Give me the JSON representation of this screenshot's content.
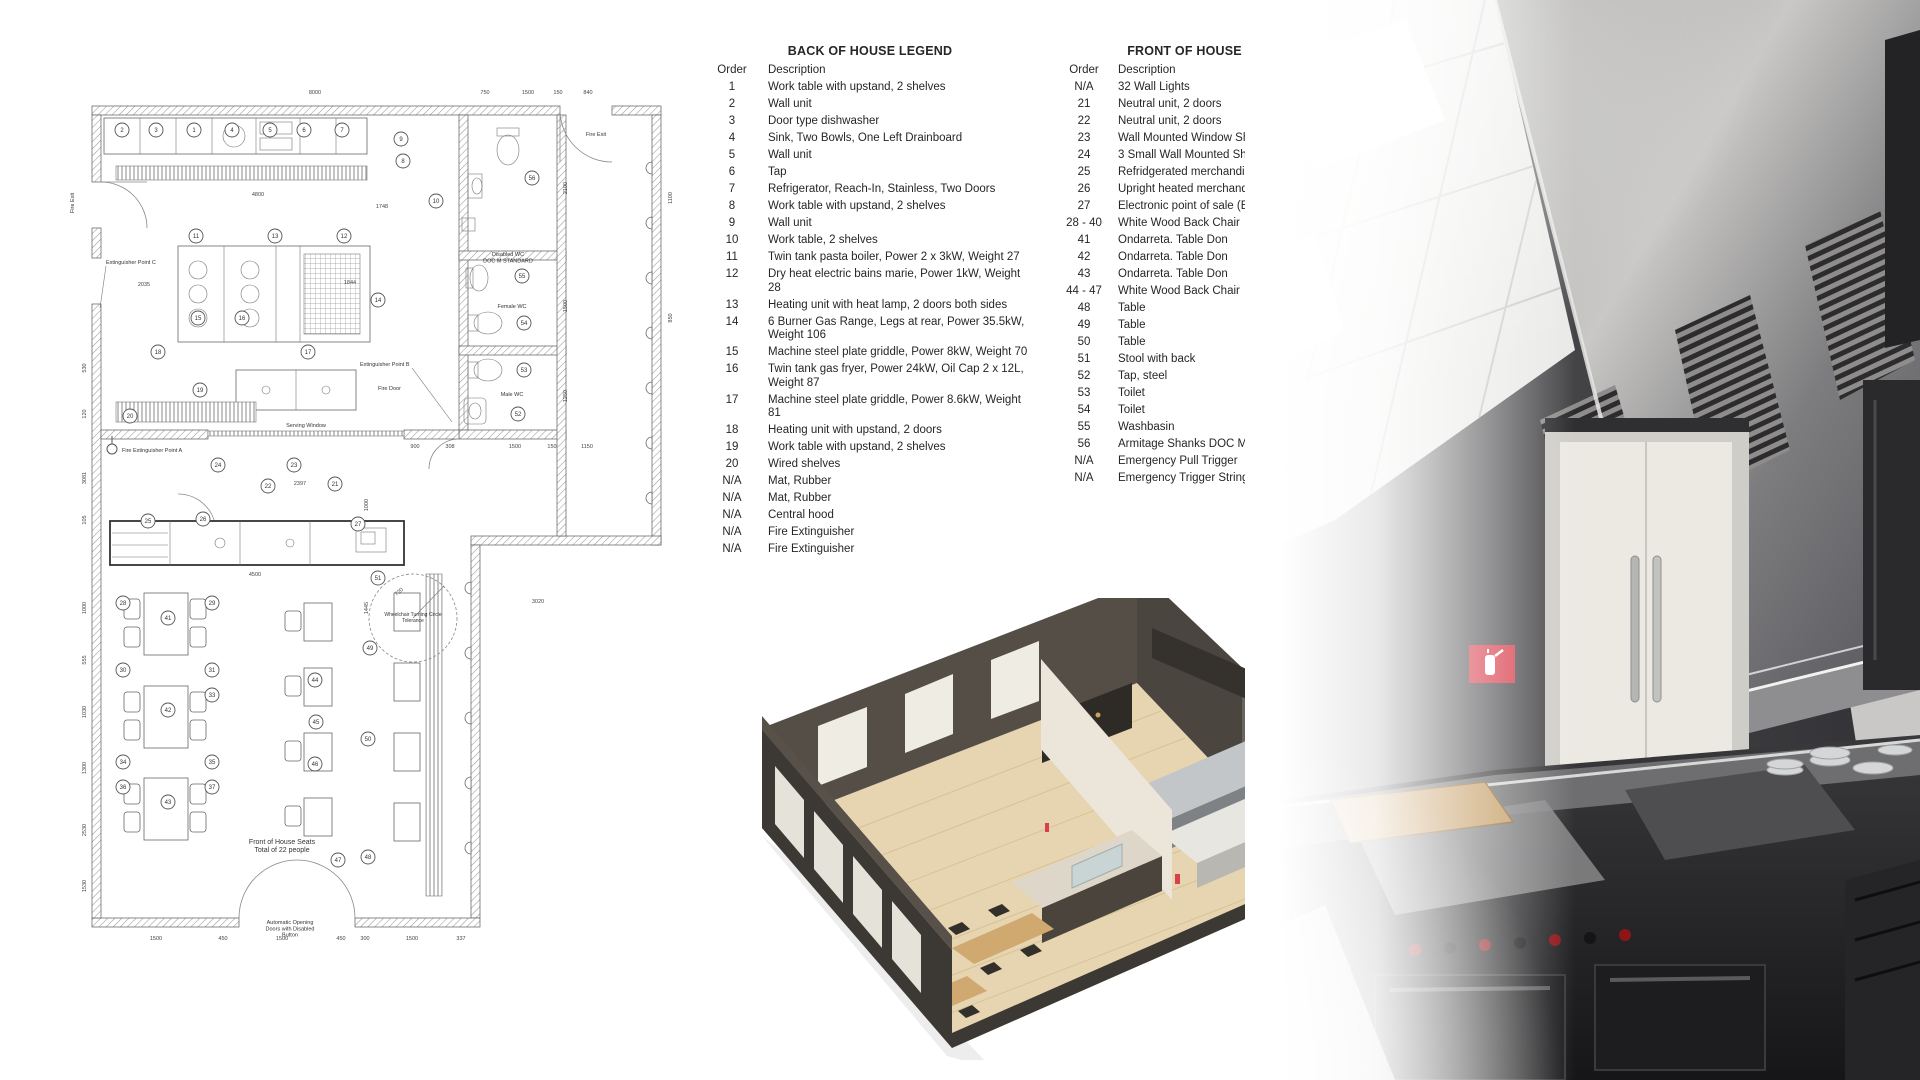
{
  "colors": {
    "accent-red": "#d9404e",
    "plan-line": "#5a5a5a",
    "legend-text": "#262626",
    "iso-floor": "#e6d5b0",
    "iso-wall": "#4a453e",
    "iso-wood": "#cfa970",
    "photo-wall": "#3b3a3c",
    "photo-steel": "#b9b8b6"
  },
  "legends": {
    "boh": {
      "title": "BACK OF HOUSE LEGEND",
      "order_header": "Order",
      "description_header": "Description",
      "rows": [
        [
          "1",
          "Work table with upstand, 2 shelves"
        ],
        [
          "2",
          "Wall unit"
        ],
        [
          "3",
          "Door type dishwasher"
        ],
        [
          "4",
          "Sink, Two Bowls, One Left Drainboard"
        ],
        [
          "5",
          "Wall unit"
        ],
        [
          "6",
          "Tap"
        ],
        [
          "7",
          "Refrigerator, Reach-In, Stainless, Two Doors"
        ],
        [
          "8",
          "Work table with upstand, 2 shelves"
        ],
        [
          "9",
          "Wall unit"
        ],
        [
          "10",
          "Work table, 2 shelves"
        ],
        [
          "11",
          "Twin tank pasta boiler, Power 2 x 3kW, Weight 27"
        ],
        [
          "12",
          "Dry heat electric bains marie, Power 1kW, Weight 28"
        ],
        [
          "13",
          "Heating unit with heat lamp, 2 doors both sides"
        ],
        [
          "14",
          "6 Burner Gas Range, Legs at rear, Power 35.5kW, Weight 106"
        ],
        [
          "15",
          "Machine steel plate griddle, Power 8kW, Weight 70"
        ],
        [
          "16",
          "Twin tank gas fryer, Power 24kW, Oil Cap 2 x 12L, Weight 87"
        ],
        [
          "17",
          "Machine steel plate griddle, Power 8.6kW, Weight 81"
        ],
        [
          "18",
          "Heating unit with upstand, 2 doors"
        ],
        [
          "19",
          "Work table with upstand, 2 shelves"
        ],
        [
          "20",
          "Wired shelves"
        ],
        [
          "N/A",
          "Mat, Rubber"
        ],
        [
          "N/A",
          "Mat, Rubber"
        ],
        [
          "N/A",
          "Central hood"
        ],
        [
          "N/A",
          "Fire Extinguisher"
        ],
        [
          "N/A",
          "Fire Extinguisher"
        ]
      ]
    },
    "foh": {
      "title": "FRONT OF HOUSE LEGEND",
      "order_header": "Order",
      "description_header": "Description",
      "rows": [
        [
          "N/A",
          "32 Wall Lights"
        ],
        [
          "21",
          "Neutral unit, 2 doors"
        ],
        [
          "22",
          "Neutral unit, 2 doors"
        ],
        [
          "23",
          "Wall Mounted Window Shelf"
        ],
        [
          "24",
          "3 Small Wall Mounted Shelves"
        ],
        [
          "25",
          "Refridgerated merchandiser"
        ],
        [
          "26",
          "Upright heated merchandiser"
        ],
        [
          "27",
          "Electronic point of sale (EPOS system)"
        ],
        [
          "28 - 40",
          "White Wood Back Chair"
        ],
        [
          "41",
          "Ondarreta. Table Don"
        ],
        [
          "42",
          "Ondarreta. Table Don"
        ],
        [
          "43",
          "Ondarreta. Table Don"
        ],
        [
          "44 - 47",
          "White Wood Back Chair"
        ],
        [
          "48",
          "Table"
        ],
        [
          "49",
          "Table"
        ],
        [
          "50",
          "Table"
        ],
        [
          "51",
          "Stool with back"
        ],
        [
          "52",
          "Tap, steel"
        ],
        [
          "53",
          "Toilet"
        ],
        [
          "54",
          "Toilet"
        ],
        [
          "55",
          "Washbasin"
        ],
        [
          "56",
          "Armitage Shanks DOC M Pack L"
        ],
        [
          "N/A",
          "Emergency Pull Trigger"
        ],
        [
          "N/A",
          "Emergency Trigger String"
        ]
      ]
    }
  },
  "floor_plan": {
    "labels": [
      {
        "t": "Fire Exit",
        "x": 14,
        "y": 185,
        "s": 5.5,
        "r": -90
      },
      {
        "t": "Fire Exit",
        "x": 536,
        "y": 118,
        "s": 5.5
      },
      {
        "t": "Extinguisher Point C",
        "x": 46,
        "y": 246,
        "s": 5.5,
        "a": "start"
      },
      {
        "t": "Extinguisher Point B",
        "x": 300,
        "y": 348,
        "s": 5.5,
        "a": "start"
      },
      {
        "t": "Fire Door",
        "x": 318,
        "y": 372,
        "s": 5.5,
        "a": "start"
      },
      {
        "t": "Fire Extinguisher Point A",
        "x": 62,
        "y": 434,
        "s": 5.5,
        "a": "start"
      },
      {
        "t": "Serving Window",
        "x": 246,
        "y": 409,
        "s": 5.5
      },
      {
        "t": "Disabled WC\nDOC M STANDARD",
        "x": 448,
        "y": 238,
        "s": 5.5
      },
      {
        "t": "Female WC",
        "x": 452,
        "y": 290,
        "s": 5.5
      },
      {
        "t": "Male WC",
        "x": 452,
        "y": 378,
        "s": 5.5
      },
      {
        "t": "Wheelchair Turning Circle\nTolerance",
        "x": 353,
        "y": 598,
        "s": 5
      },
      {
        "t": "Front of House Seats\nTotal of 22 people",
        "x": 222,
        "y": 826,
        "s": 7
      },
      {
        "t": "Automatic Opening\nDoors with Disabled\nButton",
        "x": 230,
        "y": 906,
        "s": 5.5
      }
    ],
    "dims": [
      {
        "t": "8000",
        "x": 255,
        "y": 76
      },
      {
        "t": "750",
        "x": 425,
        "y": 76
      },
      {
        "t": "1500",
        "x": 468,
        "y": 76
      },
      {
        "t": "150",
        "x": 498,
        "y": 76
      },
      {
        "t": "840",
        "x": 528,
        "y": 76
      },
      {
        "t": "2100",
        "x": 507,
        "y": 170,
        "r": -90
      },
      {
        "t": "1500",
        "x": 507,
        "y": 288,
        "r": -90
      },
      {
        "t": "1250",
        "x": 507,
        "y": 378,
        "r": -90
      },
      {
        "t": "850",
        "x": 612,
        "y": 300,
        "r": -90
      },
      {
        "t": "1100",
        "x": 612,
        "y": 180,
        "r": -90
      },
      {
        "t": "530",
        "x": 26,
        "y": 350,
        "r": -90
      },
      {
        "t": "120",
        "x": 26,
        "y": 396,
        "r": -90
      },
      {
        "t": "3081",
        "x": 26,
        "y": 460,
        "r": -90
      },
      {
        "t": "105",
        "x": 26,
        "y": 502,
        "r": -90
      },
      {
        "t": "1000",
        "x": 26,
        "y": 590,
        "r": -90
      },
      {
        "t": "555",
        "x": 26,
        "y": 642,
        "r": -90
      },
      {
        "t": "1030",
        "x": 26,
        "y": 694,
        "r": -90
      },
      {
        "t": "1300",
        "x": 26,
        "y": 750,
        "r": -90
      },
      {
        "t": "2530",
        "x": 26,
        "y": 812,
        "r": -90
      },
      {
        "t": "1530",
        "x": 26,
        "y": 868,
        "r": -90
      },
      {
        "t": "4800",
        "x": 198,
        "y": 178
      },
      {
        "t": "2035",
        "x": 84,
        "y": 268
      },
      {
        "t": "1748",
        "x": 322,
        "y": 190
      },
      {
        "t": "1844",
        "x": 290,
        "y": 266
      },
      {
        "t": "2397",
        "x": 240,
        "y": 467
      },
      {
        "t": "1000",
        "x": 308,
        "y": 487,
        "r": -90
      },
      {
        "t": "4500",
        "x": 195,
        "y": 558
      },
      {
        "t": "3020",
        "x": 478,
        "y": 585
      },
      {
        "t": "1445",
        "x": 308,
        "y": 590,
        "r": -90
      },
      {
        "t": "720",
        "x": 340,
        "y": 575,
        "r": -40
      },
      {
        "t": "900",
        "x": 355,
        "y": 430
      },
      {
        "t": "308",
        "x": 390,
        "y": 430
      },
      {
        "t": "1500",
        "x": 455,
        "y": 430
      },
      {
        "t": "150",
        "x": 492,
        "y": 430
      },
      {
        "t": "1150",
        "x": 527,
        "y": 430
      },
      {
        "t": "1500",
        "x": 96,
        "y": 922
      },
      {
        "t": "450",
        "x": 163,
        "y": 922
      },
      {
        "t": "1500",
        "x": 222,
        "y": 922
      },
      {
        "t": "450",
        "x": 281,
        "y": 922
      },
      {
        "t": "300",
        "x": 305,
        "y": 922
      },
      {
        "t": "1500",
        "x": 352,
        "y": 922
      },
      {
        "t": "337",
        "x": 401,
        "y": 922
      }
    ],
    "circles": [
      {
        "n": "2",
        "x": 62,
        "y": 112
      },
      {
        "n": "3",
        "x": 96,
        "y": 112
      },
      {
        "n": "1",
        "x": 134,
        "y": 112
      },
      {
        "n": "4",
        "x": 172,
        "y": 112
      },
      {
        "n": "5",
        "x": 210,
        "y": 112
      },
      {
        "n": "6",
        "x": 244,
        "y": 112
      },
      {
        "n": "7",
        "x": 282,
        "y": 112
      },
      {
        "n": "9",
        "x": 341,
        "y": 121
      },
      {
        "n": "8",
        "x": 343,
        "y": 143
      },
      {
        "n": "10",
        "x": 376,
        "y": 183
      },
      {
        "n": "11",
        "x": 136,
        "y": 218
      },
      {
        "n": "13",
        "x": 215,
        "y": 218
      },
      {
        "n": "12",
        "x": 284,
        "y": 218
      },
      {
        "n": "14",
        "x": 318,
        "y": 282
      },
      {
        "n": "15",
        "x": 138,
        "y": 300
      },
      {
        "n": "16",
        "x": 182,
        "y": 300
      },
      {
        "n": "17",
        "x": 248,
        "y": 334
      },
      {
        "n": "18",
        "x": 98,
        "y": 334
      },
      {
        "n": "19",
        "x": 140,
        "y": 372
      },
      {
        "n": "20",
        "x": 70,
        "y": 398
      },
      {
        "n": "24",
        "x": 158,
        "y": 447
      },
      {
        "n": "23",
        "x": 234,
        "y": 447
      },
      {
        "n": "22",
        "x": 208,
        "y": 468
      },
      {
        "n": "21",
        "x": 275,
        "y": 466
      },
      {
        "n": "25",
        "x": 88,
        "y": 503
      },
      {
        "n": "26",
        "x": 143,
        "y": 501
      },
      {
        "n": "27",
        "x": 298,
        "y": 506
      },
      {
        "n": "56",
        "x": 472,
        "y": 160
      },
      {
        "n": "55",
        "x": 462,
        "y": 258
      },
      {
        "n": "54",
        "x": 464,
        "y": 305
      },
      {
        "n": "53",
        "x": 464,
        "y": 352
      },
      {
        "n": "52",
        "x": 458,
        "y": 396
      },
      {
        "n": "41",
        "x": 108,
        "y": 600
      },
      {
        "n": "42",
        "x": 108,
        "y": 692
      },
      {
        "n": "43",
        "x": 108,
        "y": 784
      },
      {
        "n": "28",
        "x": 63,
        "y": 585
      },
      {
        "n": "29",
        "x": 152,
        "y": 585
      },
      {
        "n": "30",
        "x": 63,
        "y": 652
      },
      {
        "n": "31",
        "x": 152,
        "y": 652
      },
      {
        "n": "33",
        "x": 152,
        "y": 677
      },
      {
        "n": "34",
        "x": 63,
        "y": 744
      },
      {
        "n": "35",
        "x": 152,
        "y": 744
      },
      {
        "n": "36",
        "x": 63,
        "y": 769
      },
      {
        "n": "37",
        "x": 152,
        "y": 769
      },
      {
        "n": "49",
        "x": 310,
        "y": 630
      },
      {
        "n": "44",
        "x": 255,
        "y": 662
      },
      {
        "n": "45",
        "x": 256,
        "y": 704
      },
      {
        "n": "46",
        "x": 255,
        "y": 746
      },
      {
        "n": "50",
        "x": 308,
        "y": 721
      },
      {
        "n": "51",
        "x": 318,
        "y": 560
      },
      {
        "n": "47",
        "x": 278,
        "y": 842
      },
      {
        "n": "48",
        "x": 308,
        "y": 839
      }
    ]
  }
}
